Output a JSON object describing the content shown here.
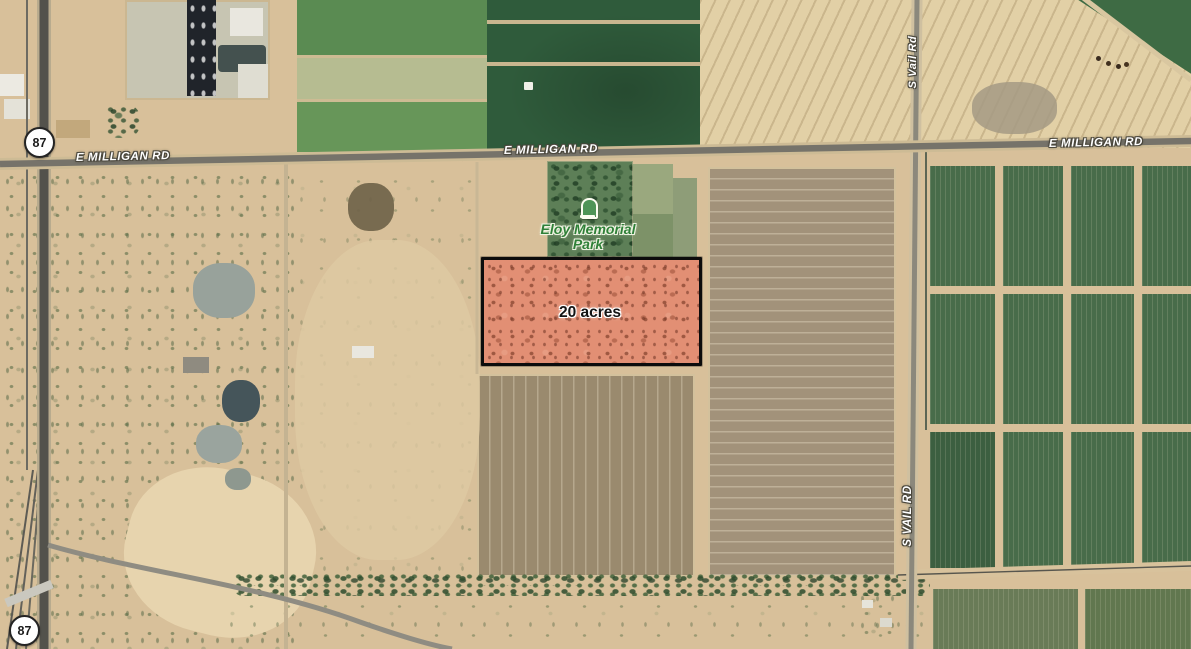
{
  "map": {
    "view": "satellite",
    "parcel": {
      "label": "20 acres",
      "fill_color": "#e28f74",
      "border_color": "#0c0c0c"
    },
    "roads": {
      "milligan_label": "E MILLIGAN RD",
      "vail_label_mixed": "S Vail Rd",
      "vail_label_caps": "S VAIL RD",
      "route_87_shield": "87"
    },
    "poi": {
      "park_line1": "Eloy Memorial",
      "park_line2": "Park",
      "icon": "tombstone-icon",
      "label_color": "#2f8038"
    }
  }
}
